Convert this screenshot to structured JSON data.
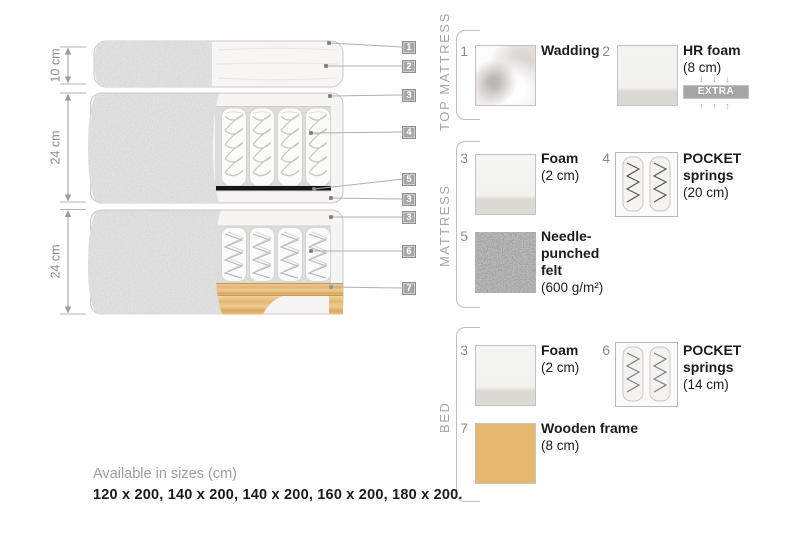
{
  "diagram": {
    "dimensions": [
      {
        "label": "10 cm"
      },
      {
        "label": "24 cm"
      },
      {
        "label": "24 cm"
      }
    ],
    "callouts": [
      {
        "label": "1"
      },
      {
        "label": "2"
      },
      {
        "label": "3"
      },
      {
        "label": "4"
      },
      {
        "label": "5"
      },
      {
        "label": "3"
      },
      {
        "label": "3"
      },
      {
        "label": "6"
      },
      {
        "label": "7"
      }
    ]
  },
  "legend": {
    "sections": [
      {
        "label": "TOP MATTRESS",
        "items": [
          {
            "num": "1",
            "title": "Wadding",
            "sub": ""
          },
          {
            "num": "2",
            "title": "HR foam",
            "sub": "(8 cm)",
            "arrows_down": "↓ ↓ ↓",
            "badge": "EXTRA SOFT",
            "arrows_up": "↑ ↑ ↑"
          }
        ]
      },
      {
        "label": "MATTRESS",
        "items": [
          {
            "num": "3",
            "title": "Foam",
            "sub": "(2 cm)"
          },
          {
            "num": "4",
            "title": "POCKET springs",
            "sub": "(20 cm)"
          },
          {
            "num": "5",
            "title": "Needle-punched felt",
            "sub": "(600 g/m²)"
          }
        ]
      },
      {
        "label": "BED",
        "items": [
          {
            "num": "3",
            "title": "Foam",
            "sub": "(2 cm)"
          },
          {
            "num": "6",
            "title": "POCKET springs",
            "sub": "(14 cm)"
          },
          {
            "num": "7",
            "title": "Wooden frame",
            "sub": "(8 cm)"
          }
        ]
      }
    ]
  },
  "footer": {
    "line1": "Available in sizes (cm)",
    "line2": "120 x 200, 140 x 200, 140 x 200, 160 x 200, 180 x 200."
  },
  "colors": {
    "fabric_grey": "#b4b4b4",
    "wood_tan": "#e2b26a",
    "badge_grey": "#a6a6a6",
    "felt_dark": "#6f6f6f",
    "text_dark": "#1c1c1c",
    "text_grey": "#8d8d8d"
  }
}
